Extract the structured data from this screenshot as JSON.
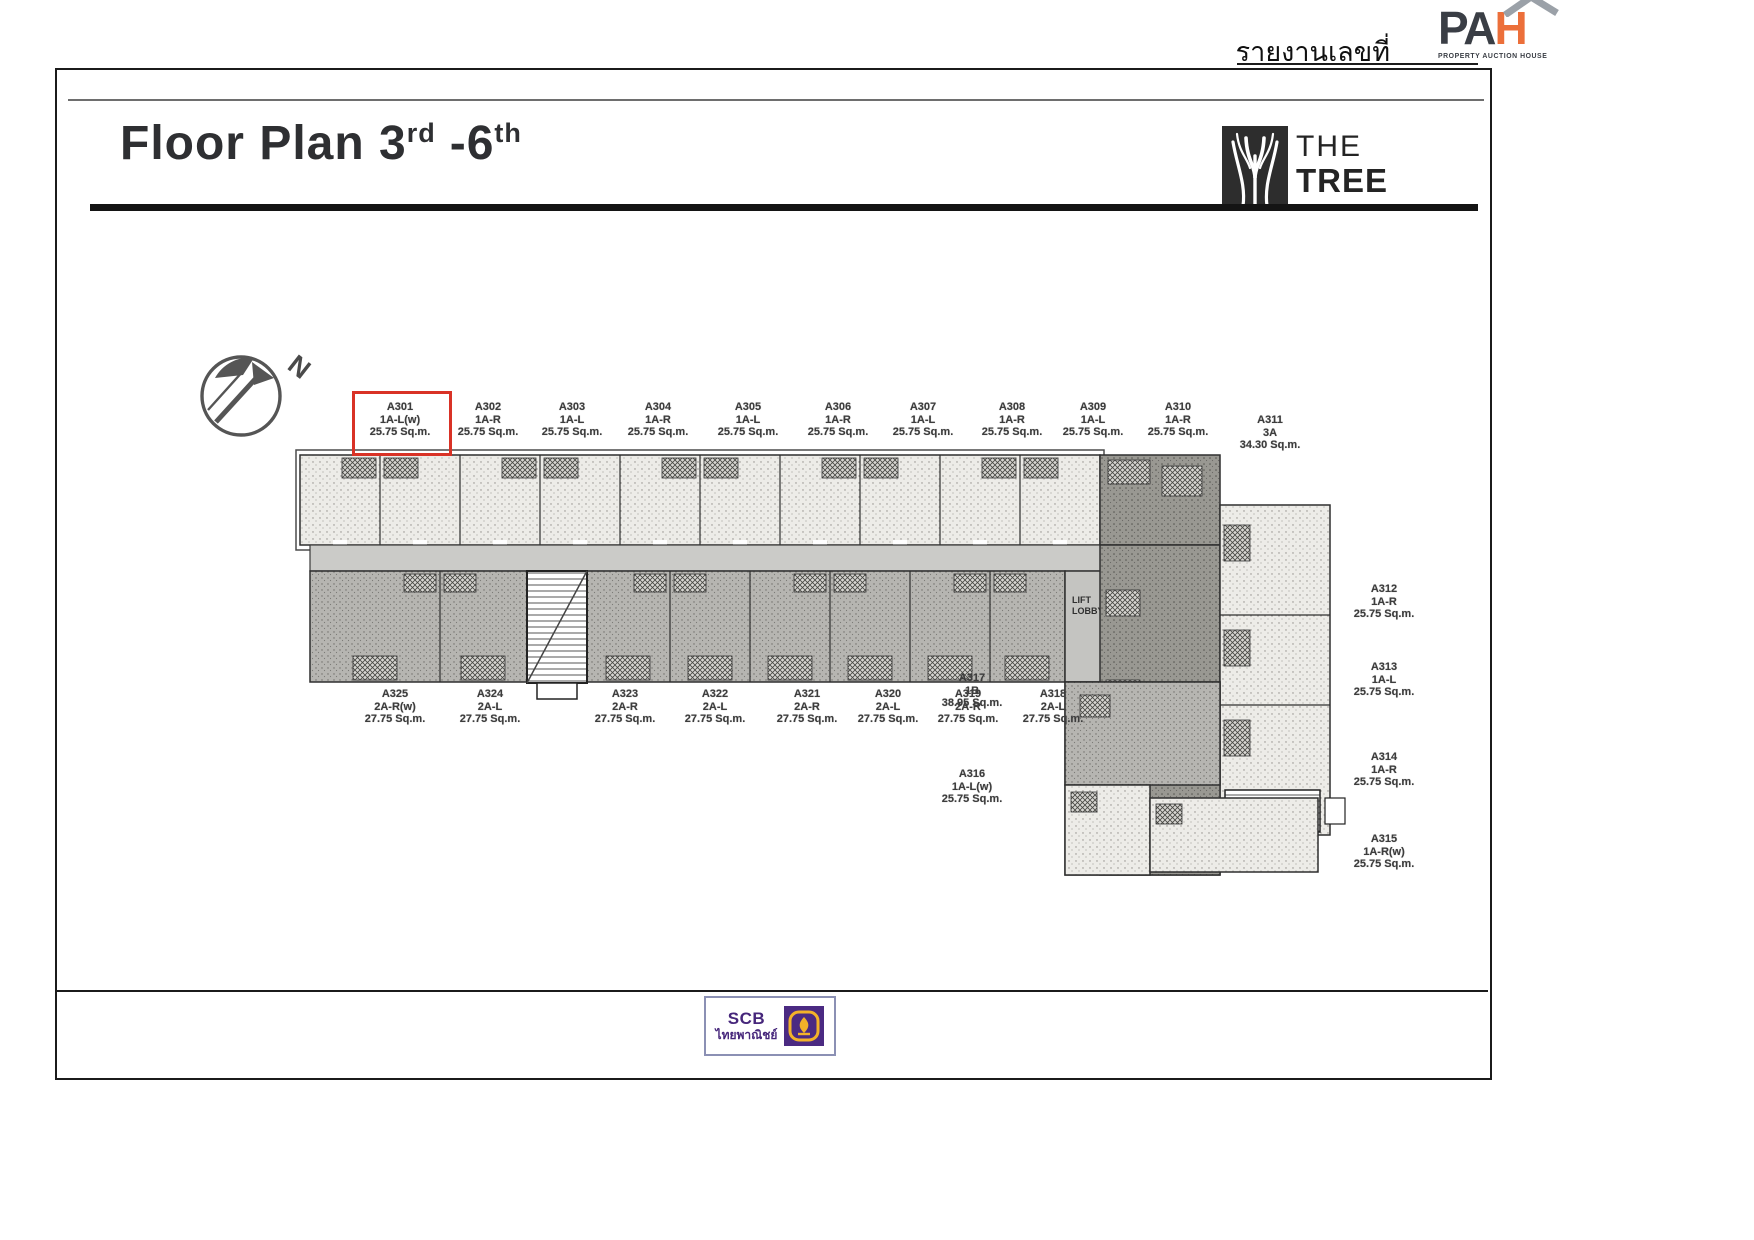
{
  "header": {
    "report_label": "รายงานเลขที่",
    "pah_logo": {
      "pa": "PA",
      "h": "H",
      "caption": "PROPERTY AUCTION HOUSE"
    }
  },
  "title": {
    "part1": "Floor Plan 3",
    "sup1": "rd",
    "part2": "-6",
    "sup2": "th"
  },
  "brand": {
    "name_line1": "THE",
    "name_line2": "TREE"
  },
  "compass": {
    "north_label": "N"
  },
  "plan": {
    "lift_line1": "LIFT",
    "lift_line2": "LOBBY",
    "highlighted_unit": "A301",
    "highlight_color": "#d93226",
    "units_top": [
      {
        "id": "A301",
        "type": "1A-L(w)",
        "area": "25.75 Sq.m."
      },
      {
        "id": "A302",
        "type": "1A-R",
        "area": "25.75 Sq.m."
      },
      {
        "id": "A303",
        "type": "1A-L",
        "area": "25.75 Sq.m."
      },
      {
        "id": "A304",
        "type": "1A-R",
        "area": "25.75 Sq.m."
      },
      {
        "id": "A305",
        "type": "1A-L",
        "area": "25.75 Sq.m."
      },
      {
        "id": "A306",
        "type": "1A-R",
        "area": "25.75 Sq.m."
      },
      {
        "id": "A307",
        "type": "1A-L",
        "area": "25.75 Sq.m."
      },
      {
        "id": "A308",
        "type": "1A-R",
        "area": "25.75 Sq.m."
      },
      {
        "id": "A309",
        "type": "1A-L",
        "area": "25.75 Sq.m."
      },
      {
        "id": "A310",
        "type": "1A-R",
        "area": "25.75 Sq.m."
      },
      {
        "id": "A311",
        "type": "3A",
        "area": "34.30 Sq.m."
      }
    ],
    "units_bottom": [
      {
        "id": "A325",
        "type": "2A-R(w)",
        "area": "27.75 Sq.m."
      },
      {
        "id": "A324",
        "type": "2A-L",
        "area": "27.75 Sq.m."
      },
      {
        "id": "A323",
        "type": "2A-R",
        "area": "27.75 Sq.m."
      },
      {
        "id": "A322",
        "type": "2A-L",
        "area": "27.75 Sq.m."
      },
      {
        "id": "A321",
        "type": "2A-R",
        "area": "27.75 Sq.m."
      },
      {
        "id": "A320",
        "type": "2A-L",
        "area": "27.75 Sq.m."
      },
      {
        "id": "A319",
        "type": "2A-R",
        "area": "27.75 Sq.m."
      },
      {
        "id": "A318",
        "type": "2A-L",
        "area": "27.75 Sq.m."
      }
    ],
    "units_right": [
      {
        "id": "A312",
        "type": "1A-R",
        "area": "25.75 Sq.m."
      },
      {
        "id": "A313",
        "type": "1A-L",
        "area": "25.75 Sq.m."
      },
      {
        "id": "A314",
        "type": "1A-R",
        "area": "25.75 Sq.m."
      },
      {
        "id": "A315",
        "type": "1A-R(w)",
        "area": "25.75 Sq.m."
      }
    ],
    "units_inner": [
      {
        "id": "A317",
        "type": "1B",
        "area": "38.95 Sq.m."
      },
      {
        "id": "A316",
        "type": "1A-L(w)",
        "area": "25.75 Sq.m."
      }
    ]
  },
  "footer": {
    "scb_abbr": "SCB",
    "scb_thai": "ไทยพาณิชย์"
  }
}
